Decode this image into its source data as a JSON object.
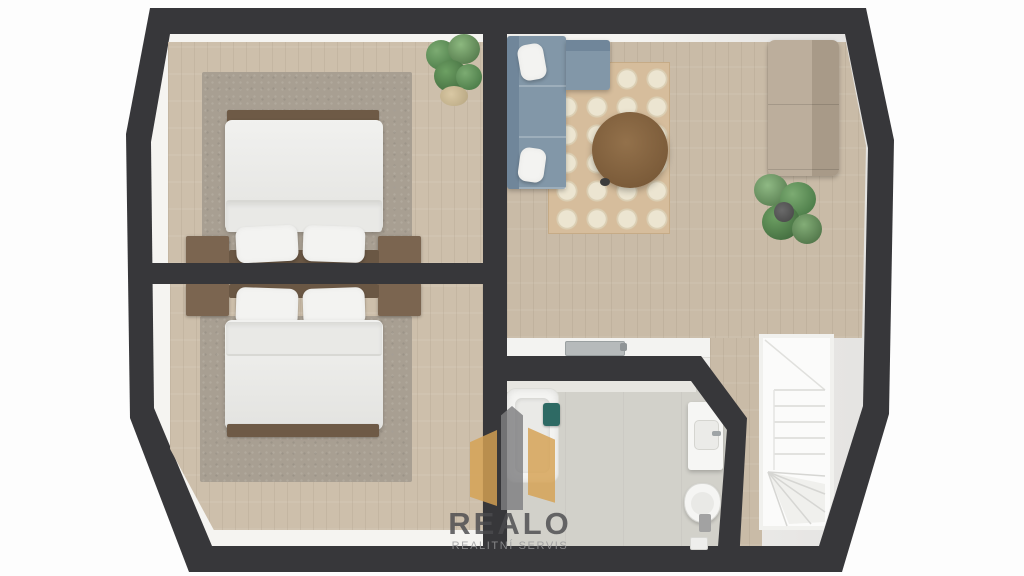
{
  "watermark": {
    "brand": "REALO",
    "tagline": "REALITNÍ SERVIS",
    "icon": "house-icon"
  },
  "floorplan": {
    "rooms": [
      {
        "id": "bedroom-top",
        "furniture": [
          "double-bed",
          "two-pillows",
          "two-nightstands",
          "area-rug",
          "potted-plant"
        ]
      },
      {
        "id": "bedroom-bottom",
        "furniture": [
          "double-bed",
          "two-pillows",
          "two-nightstands",
          "area-rug"
        ]
      },
      {
        "id": "living-room",
        "furniture": [
          "corner-sofa-blue",
          "patterned-rug",
          "round-coffee-table",
          "sofa-beige",
          "potted-plant",
          "counter-with-sink"
        ]
      },
      {
        "id": "bathroom",
        "furniture": [
          "bathtub",
          "vanity-sink",
          "toilet",
          "teal-bin"
        ]
      },
      {
        "id": "stairwell",
        "furniture": [
          "winder-staircase"
        ]
      }
    ]
  },
  "palette": {
    "wall": "#37373a",
    "wood": "#cdbfab",
    "wood2": "#c9bba7",
    "bath_floor": "#d2d1ca",
    "rug_bedroom": "#a89f92",
    "rug_living": "#d6bd9c",
    "sofa_blue": "#8297a8",
    "sofa_blue_dark": "#70869a",
    "sofa_beige": "#a89a88",
    "sofa_beige_seat": "#bcae9c",
    "table": "#7c5c3a",
    "headboard": "#6a5744",
    "nightstand": "#7b6550",
    "frame_brown": "#6e5a46",
    "duvet": "#f3f3f1",
    "teal": "#2e6a64",
    "stair": "#fbfbfa",
    "logo_tan": "#d6a253",
    "logo_gray": "#7f7f81",
    "logo_text": "#4b4b4e",
    "logo_sub": "#98989a"
  }
}
